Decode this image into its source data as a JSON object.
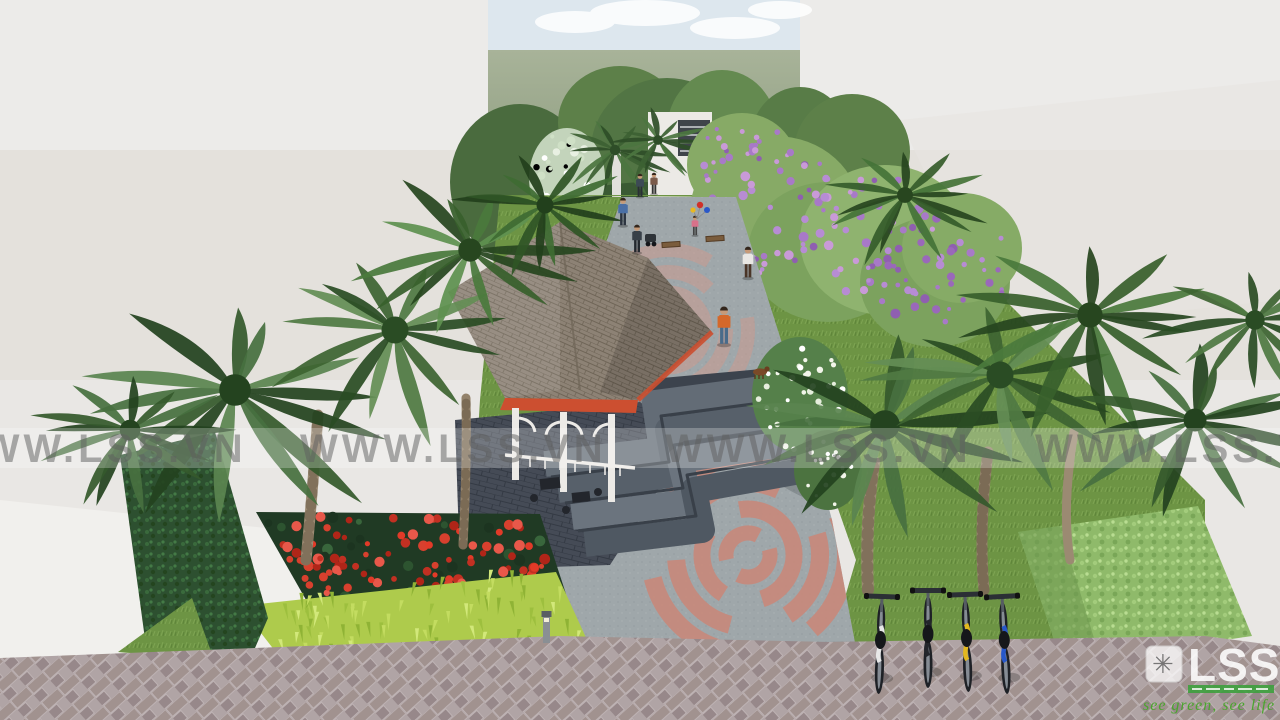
{
  "watermark": {
    "text": "WWW.LSS.VN"
  },
  "logo": {
    "text": "LSS",
    "icon_glyph": "✳",
    "tagline": "see green, see life"
  },
  "palette": {
    "wall": "#e9e7e4",
    "sky": "#dde7ee",
    "field": "#97a588",
    "grass": "#6d9444",
    "hedge_dark": "#2d5030",
    "hedge_light": "#8fba6a",
    "palm_green": "#3d5f35",
    "flower_red": "#d8402e",
    "flower_purple": "#a879c8",
    "fringe_lime": "#aecb4c",
    "path_gray": "#9fa7aa",
    "rose_inlay": "#cf998c",
    "roof_shingle": "#8d8275",
    "fascia_red": "#cc4f30",
    "column_white": "#eceae6",
    "step_gray": "#5d6671",
    "brick": "#a1928f",
    "bike_white": "#e8e8e8",
    "bike_black": "#23262b",
    "bike_yellow": "#e2b81f",
    "bike_blue": "#2657c9",
    "logo_green": "#3da03d",
    "watermark_gray": "#5f5f5f"
  },
  "scene": {
    "objects": [
      "sky",
      "backdrop-trees",
      "entry-gate",
      "pavilion",
      "terrace-steps",
      "central-walkway",
      "rose-paving-inlay",
      "palm-trees",
      "purple-flowering-trees",
      "red-flower-bed",
      "hedges",
      "lawn",
      "brick-pavement",
      "bicycles",
      "visitors",
      "bollard-light"
    ]
  }
}
